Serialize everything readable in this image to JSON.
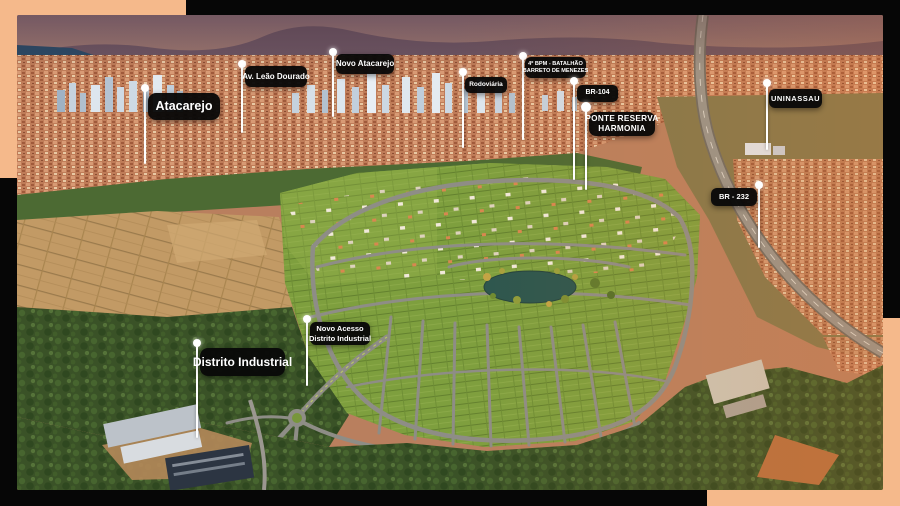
{
  "colors": {
    "page_bg": "#060606",
    "peach": "#f5b98b",
    "pill_bg": "rgba(8,8,8,0.96)",
    "pill_text": "#ffffff",
    "pin": "#ffffff"
  },
  "markers": [
    {
      "id": "atacarejo",
      "label": "Atacarejo"
    },
    {
      "id": "av-leao-dourado",
      "label": "Av. Leão Dourado"
    },
    {
      "id": "novo-atacarejo",
      "label": "Novo Atacarejo"
    },
    {
      "id": "rodoviaria",
      "label": "Rodoviária"
    },
    {
      "id": "bpm",
      "line1": "4º BPM - BATALHÃO",
      "line2": "BARRETO DE MENEZES"
    },
    {
      "id": "br-104",
      "label": "BR-104"
    },
    {
      "id": "ponte-reserva-harmonia",
      "line1": "PONTE RESERVA",
      "line2": "HARMONIA"
    },
    {
      "id": "uninassau",
      "label": "UNINASSAU"
    },
    {
      "id": "br-232",
      "label": "BR - 232"
    },
    {
      "id": "distrito-industrial",
      "label": "Distrito Industrial"
    },
    {
      "id": "novo-acesso",
      "line1": "Novo Acesso",
      "line2": "Distrito Industrial"
    }
  ]
}
